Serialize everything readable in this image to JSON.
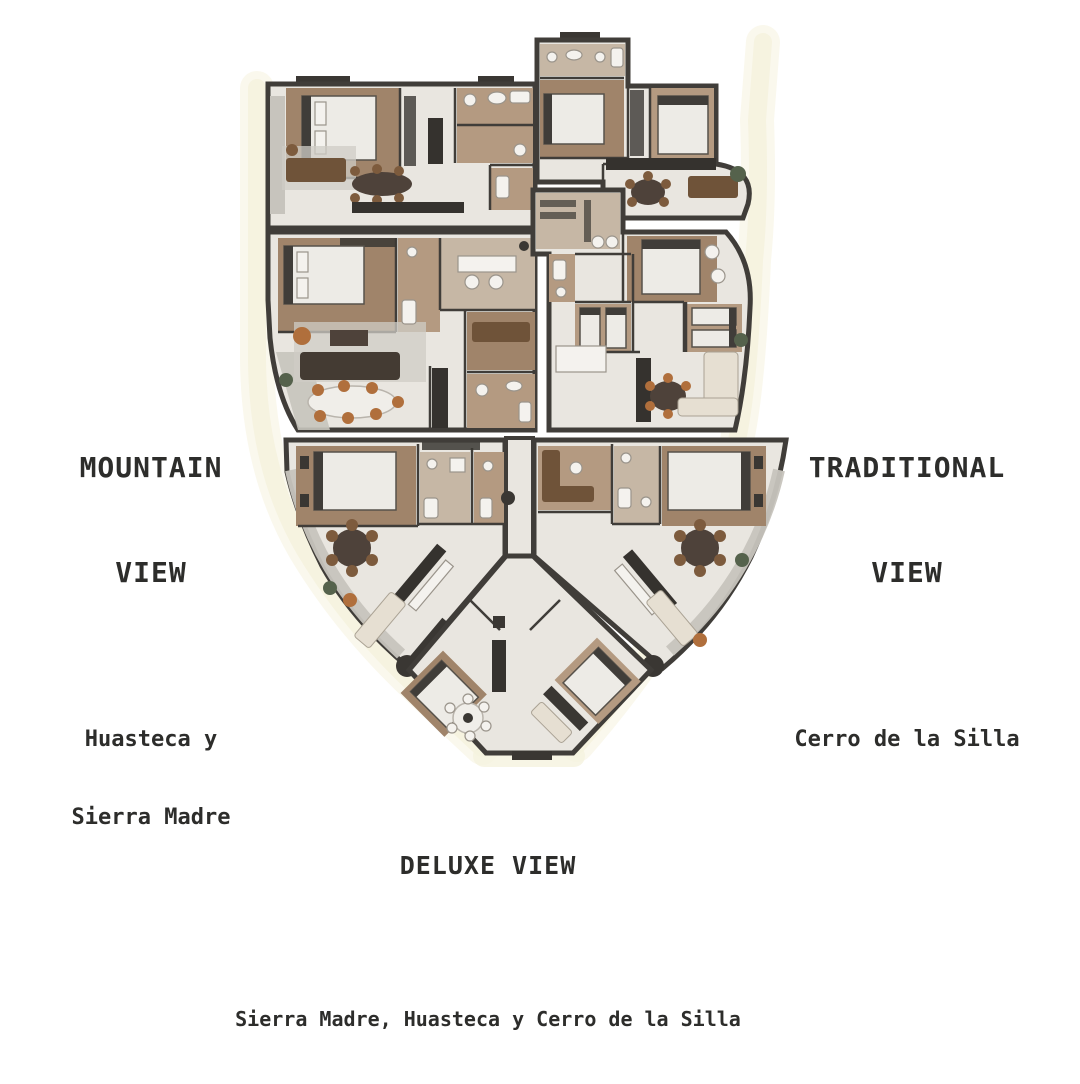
{
  "page": {
    "background": "#ffffff"
  },
  "labels": {
    "mountain": {
      "title_line1": "MOUNTAIN",
      "title_line2": "VIEW",
      "subtitle_line1": "Huasteca y",
      "subtitle_line2": "Sierra Madre"
    },
    "traditional": {
      "title_line1": "TRADITIONAL",
      "title_line2": "VIEW",
      "subtitle": "Cerro de la Silla"
    },
    "deluxe": {
      "title": "DELUXE VIEW",
      "subtitle": "Sierra Madre, Huasteca y Cerro de la Silla"
    }
  },
  "floorplan": {
    "units": [
      {
        "id": "mountain-upper"
      },
      {
        "id": "mountain-lower"
      },
      {
        "id": "traditional-upper"
      },
      {
        "id": "traditional-lower"
      },
      {
        "id": "deluxe-left"
      },
      {
        "id": "deluxe-right"
      },
      {
        "id": "deluxe-center"
      }
    ],
    "colors": {
      "wall": "#403d39",
      "floor": "#e9e6e0",
      "wood": "#a0846a",
      "tan": "#b49a81",
      "tanlight": "#c6b7a5",
      "terrace": "#c7c4bd",
      "counter": "#35322e",
      "sofa": "#6f5339",
      "sofalight": "#e6dfd2",
      "chair": "#b06f3c",
      "chairbrown": "#7d5b3d",
      "bed": "#edebe6",
      "rug": "#cfccc5",
      "tabledark": "#4e423a",
      "plant": "#55624c",
      "dark": "#3a3733",
      "glow": "#f5f2de",
      "text": "#2d2d2b"
    }
  }
}
